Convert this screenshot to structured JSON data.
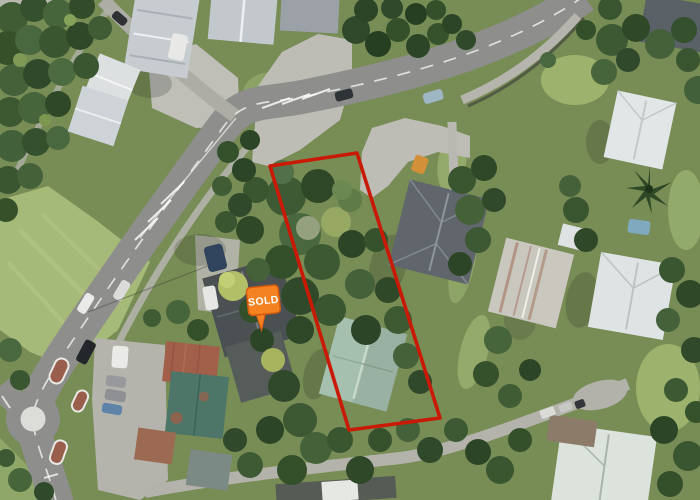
{
  "map": {
    "view": "aerial-satellite-photo",
    "overlay": {
      "boundary_color": "#c91a07",
      "marker": {
        "label": "SOLD",
        "fill": "#f58220",
        "stroke": "#d35a10",
        "text_color": "#ffffff"
      }
    }
  }
}
